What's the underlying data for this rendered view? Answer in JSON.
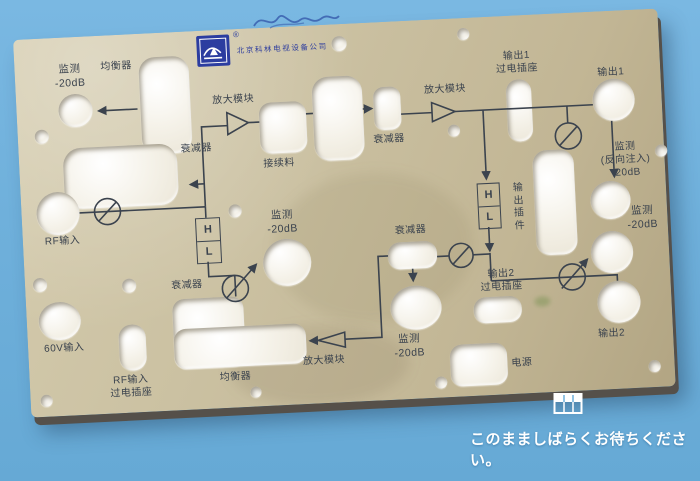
{
  "background_color": "#6fb0db",
  "status_text": "このまましばらくお待ちください。",
  "panel": {
    "brand": {
      "company": "北京科林电视设备公司",
      "registered": "®"
    },
    "labels": {
      "monitor_in": "监测\n-20dB",
      "equalizer_top": "均衡器",
      "amp_top": "放大模块",
      "splice": "接续料",
      "attenuator_top_left": "衰减器",
      "attenuator_top_right": "衰减器",
      "amp_top_right": "放大模块",
      "output1_socket": "输出1\n过电插座",
      "output1": "输出1",
      "monitor_reverse": "监测\n(反向注入)\n-20dB",
      "monitor_right": "监测\n-20dB",
      "output_plugin": "输出插件",
      "monitor_center": "监测\n-20dB",
      "attenuator_mid_left": "衰减器",
      "attenuator_mid_right": "衰减器",
      "output2_socket": "输出2\n过电插座",
      "output2": "输出2",
      "monitor_bottom": "监测\n-20dB",
      "amp_bottom": "放大模块",
      "equalizer_bottom": "均衡器",
      "power": "电源",
      "input_60v": "60V输入",
      "rf_socket": "RF输入\n过电插座",
      "rf_in": "RF输入",
      "hl_high": "H",
      "hl_low": "L"
    },
    "colors": {
      "plate": "#c9bf9f",
      "print": "#3b434e",
      "logo_blue": "#2c3da0",
      "hole": "#f6f3ea"
    }
  }
}
